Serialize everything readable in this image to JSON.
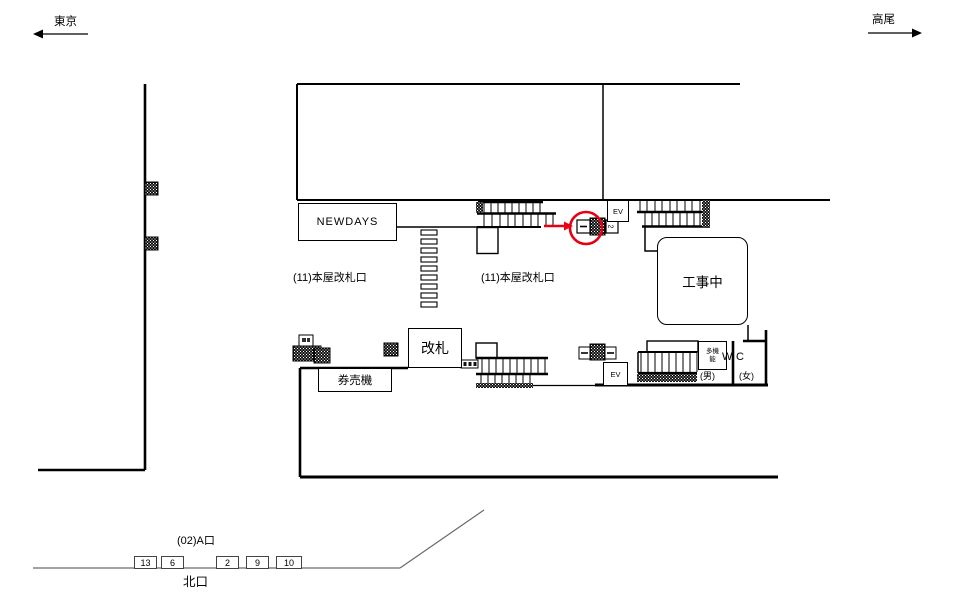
{
  "directions": {
    "left": "東京",
    "right": "高尾"
  },
  "shops": {
    "newdays": "NEWDAYS"
  },
  "concourse": {
    "gate_area_label": "(11)本屋改札口",
    "gate_box": "改札",
    "ticket_machines": "券売機",
    "construction": "工事中",
    "elevator": "EV"
  },
  "toilet": {
    "multi_line1": "多機",
    "multi_line2": "能",
    "w": "W",
    "c": "C",
    "men": "(男)",
    "women": "(女)"
  },
  "exits": {
    "a_exit": "(02)A口",
    "north_exit": "北口",
    "numbers": [
      "13",
      "6",
      "2",
      "9",
      "10"
    ]
  },
  "marker": {
    "sign_number": "2",
    "highlight_color": "#e60012"
  }
}
